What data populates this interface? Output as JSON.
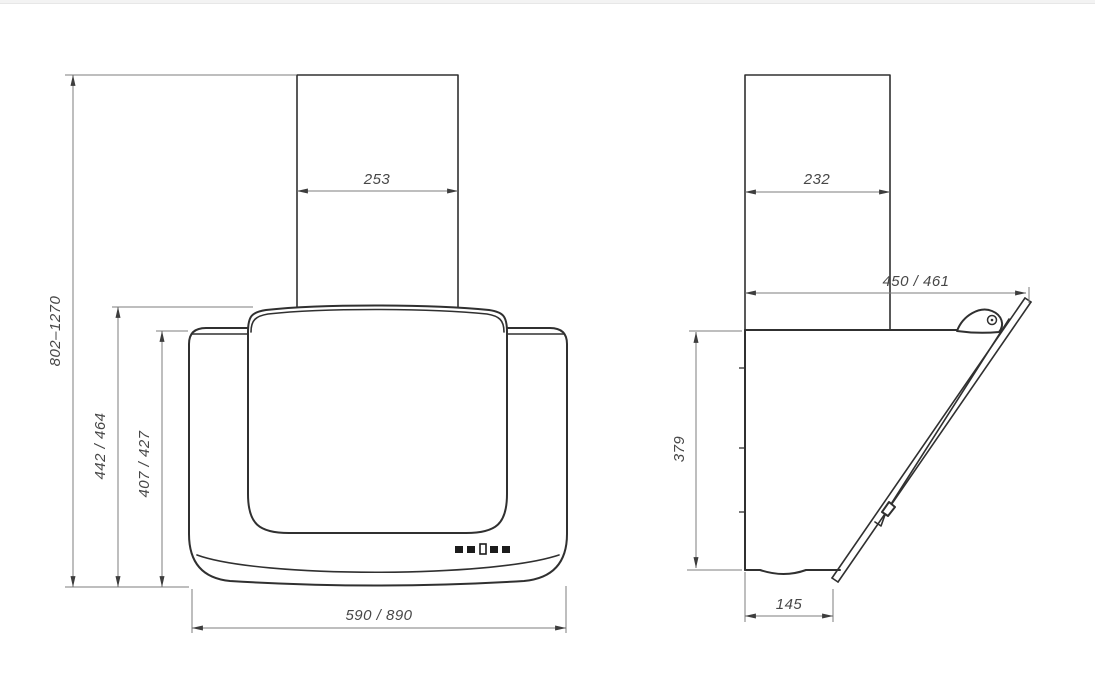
{
  "drawing": {
    "type": "technical-dimension-drawing",
    "colors": {
      "outline": "#303030",
      "dimension_lines": "#7d7d7d",
      "dimension_text": "#474747",
      "background": "#ffffff",
      "top_strip": "#f3f3f3"
    },
    "front_view": {
      "chimney_width_mm": "253",
      "mounting_height_mm": "802–1270",
      "height_to_visor_top_mm": "442 / 464",
      "body_height_mm": "407 / 427",
      "body_width_mm": "590 / 890",
      "control_buttons_count": "5"
    },
    "side_view": {
      "chimney_depth_mm": "232",
      "overall_depth_mm": "450 / 461",
      "body_height_mm": "379",
      "body_bottom_depth_mm": "145"
    }
  }
}
